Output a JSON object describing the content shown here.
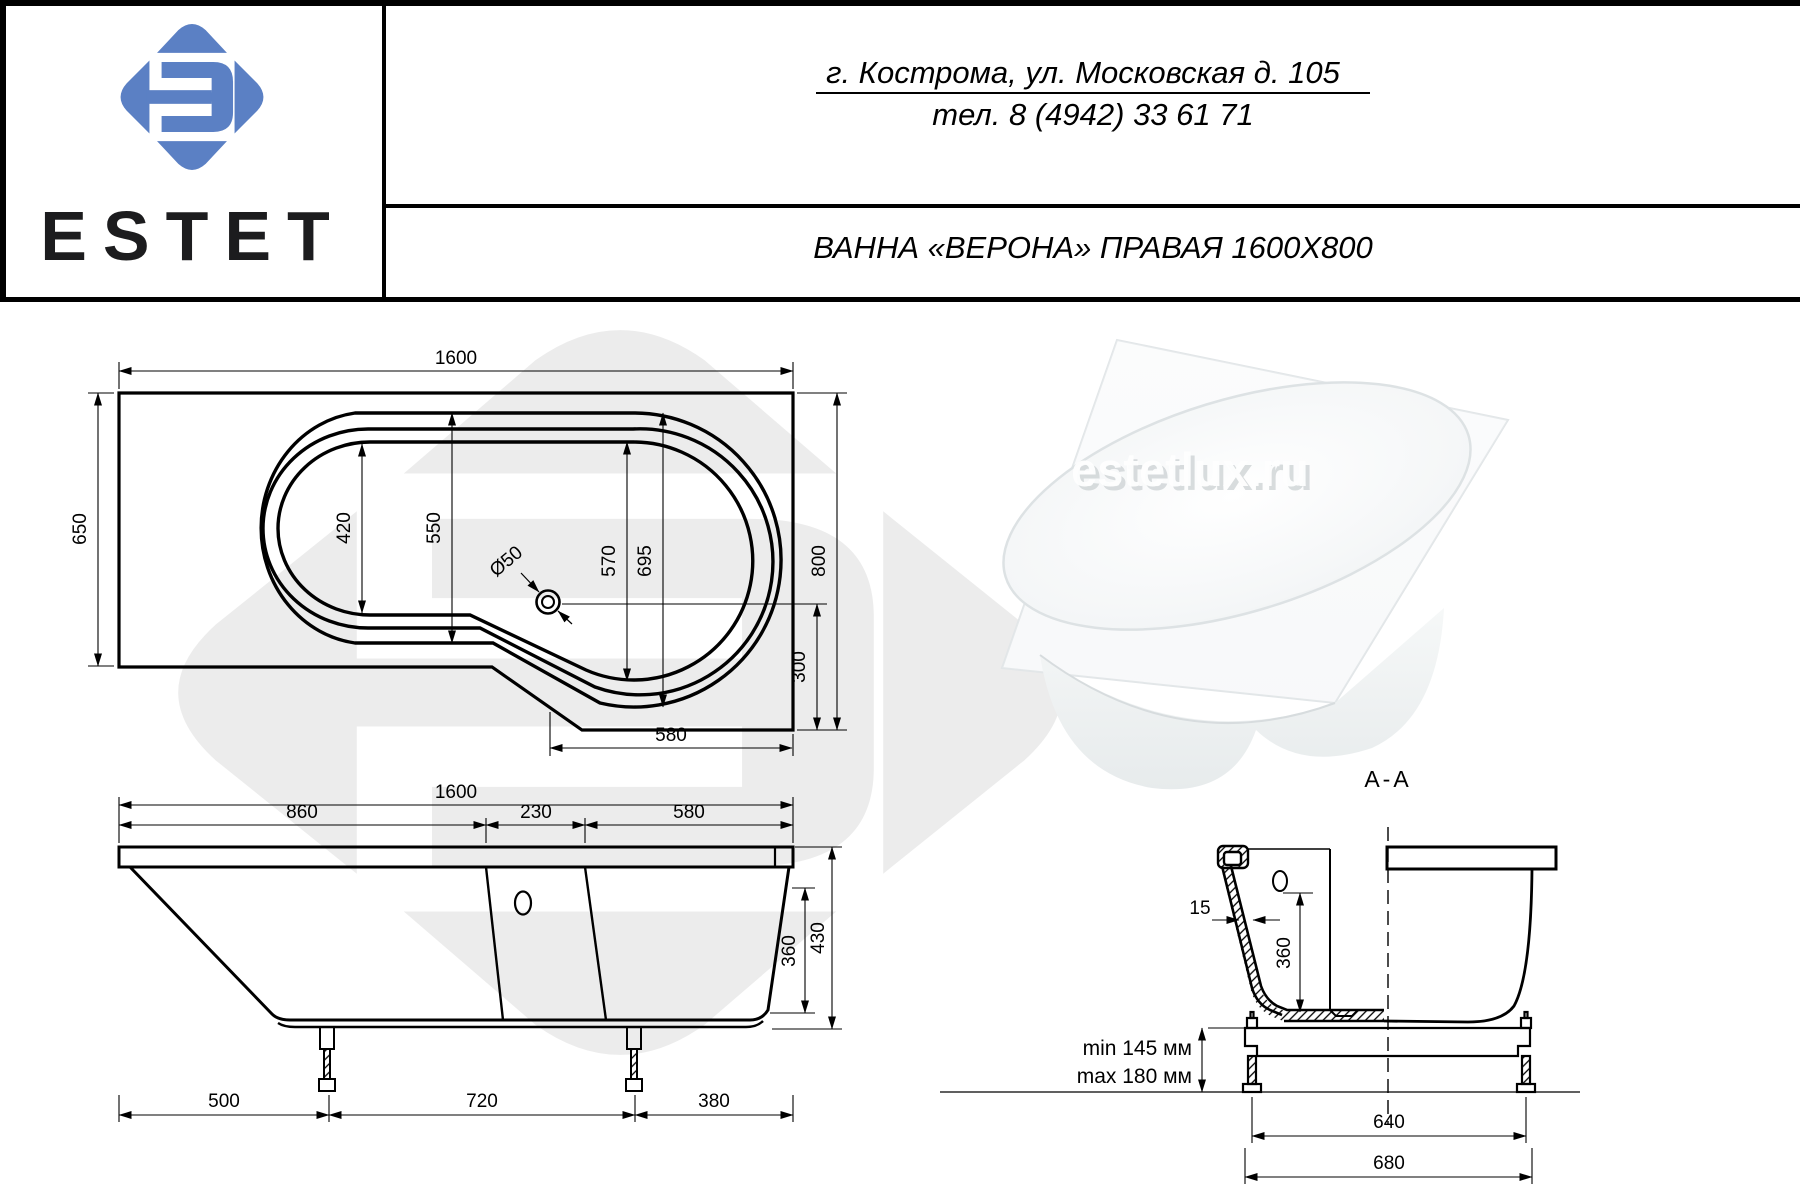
{
  "header": {
    "brand": "ESTET",
    "address_line1": "г. Кострома, ул. Московская д. 105",
    "address_line2": "тел. 8 (4942) 33 61 71",
    "title": "ВАННА «ВЕРОНА» ПРАВАЯ 1600X800"
  },
  "photo": {
    "watermark": "estetlux.ru"
  },
  "colors": {
    "logo_blue": "#5b80c4",
    "watermark_gray": "#ececec",
    "line": "#000000"
  },
  "top_view": {
    "length": "1600",
    "left_width": "650",
    "right_width": "800",
    "basin_left_inner": "420",
    "basin_mid": "550",
    "basin_right_inner": "570",
    "basin_right_outer": "695",
    "drain": "Ø50",
    "drain_to_edge": "300",
    "bottom_flat": "580"
  },
  "side_view": {
    "length": "1600",
    "seg_left": "860",
    "seg_mid": "230",
    "seg_right": "580",
    "inner_depth": "360",
    "total_height": "430",
    "feet_left": "500",
    "feet_span": "720",
    "feet_right": "380"
  },
  "section_view": {
    "label": "A-A",
    "wall_thickness": "15",
    "depth": "360",
    "frame_min": "min 145 мм",
    "frame_max": "max 180 мм",
    "frame_feet_span": "640",
    "frame_width": "680"
  }
}
